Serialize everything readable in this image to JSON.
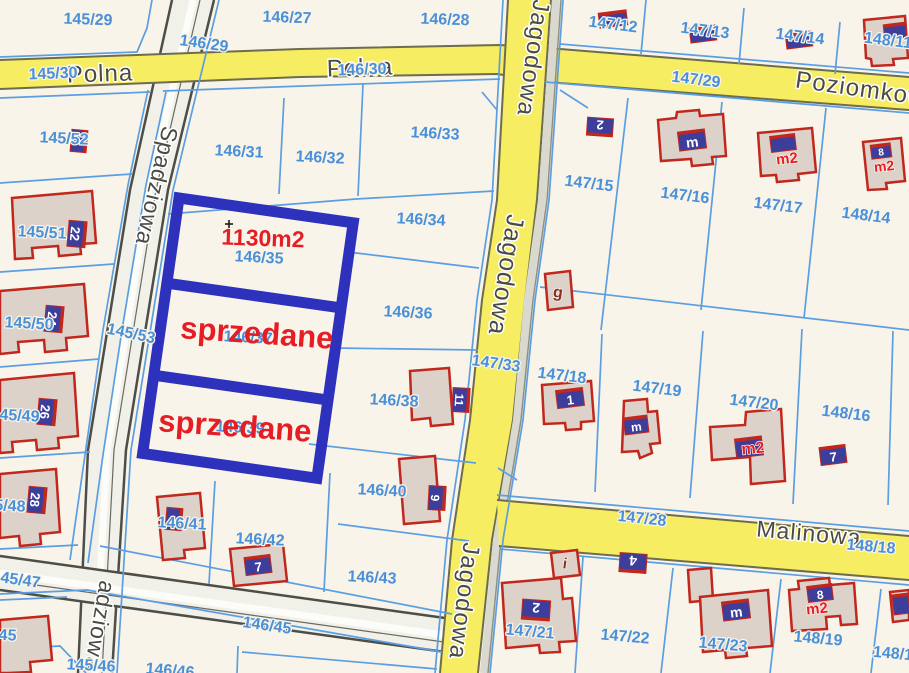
{
  "map": {
    "type": "cadastral-parcel-map",
    "colors": {
      "background": "#f8f4e9",
      "parcel_line": "#5b9ee2",
      "parcel_label": "#4a90d8",
      "street_label": "#4b4b44",
      "road_yellow": "#f6ed62",
      "road_yellow_edge": "#6d6c4e",
      "road_gray": "#f1f0e9",
      "road_gray_edge": "#4e4e48",
      "building_fill": "#ddd2ca",
      "building_outline": "#c1271c",
      "house_plate": "#3d3e9c",
      "highlight_box": "#2d31bb",
      "sold_text": "#e51d25"
    },
    "highlight": {
      "area_label": "1130m2",
      "plot_number": "146/35",
      "sold_label_1": "sprzedane",
      "sold_label_2": "sprzedane"
    },
    "streets": [
      "Polna",
      "Poziomkowa",
      "Jagodowa",
      "Spadziowa",
      "Malinowa"
    ]
  },
  "labels": [
    {
      "t": "Polna",
      "x": 100,
      "y": 74,
      "r": -2,
      "s": 24,
      "c": "s"
    },
    {
      "t": "Polna",
      "x": 360,
      "y": 68,
      "r": -2,
      "s": 24,
      "c": "s"
    },
    {
      "t": "Poziomkowa",
      "x": 868,
      "y": 90,
      "r": 8,
      "s": 24,
      "c": "s"
    },
    {
      "t": "Malinowa",
      "x": 809,
      "y": 533,
      "r": 5,
      "s": 23,
      "c": "s"
    },
    {
      "t": "Jagodowa",
      "x": 533,
      "y": 58,
      "r": 98,
      "s": 24,
      "c": "s"
    },
    {
      "t": "Jagodowa",
      "x": 506,
      "y": 275,
      "r": 99,
      "s": 25,
      "c": "s"
    },
    {
      "t": "Jagodowa",
      "x": 464,
      "y": 601,
      "r": 97,
      "s": 24,
      "c": "s"
    },
    {
      "t": "Spadziowa",
      "x": 157,
      "y": 186,
      "r": 103,
      "s": 23,
      "c": "s"
    },
    {
      "t": "adziowa",
      "x": 100,
      "y": 626,
      "r": 100,
      "s": 23,
      "c": "s"
    },
    {
      "t": "145/29",
      "x": 88,
      "y": 20,
      "r": 2,
      "s": 16,
      "c": "p"
    },
    {
      "t": "146/27",
      "x": 287,
      "y": 18,
      "r": 2,
      "s": 16,
      "c": "p"
    },
    {
      "t": "146/28",
      "x": 445,
      "y": 20,
      "r": 2,
      "s": 16,
      "c": "p"
    },
    {
      "t": "146/29",
      "x": 204,
      "y": 44,
      "r": 8,
      "s": 16,
      "c": "p"
    },
    {
      "t": "147/12",
      "x": 613,
      "y": 25,
      "r": 7,
      "s": 16,
      "c": "p"
    },
    {
      "t": "147/13",
      "x": 705,
      "y": 31,
      "r": 7,
      "s": 16,
      "c": "p"
    },
    {
      "t": "147/14",
      "x": 800,
      "y": 37,
      "r": 7,
      "s": 16,
      "c": "p"
    },
    {
      "t": "148/11",
      "x": 888,
      "y": 41,
      "r": 7,
      "s": 16,
      "c": "p"
    },
    {
      "t": "145/30",
      "x": 53,
      "y": 74,
      "r": -2,
      "s": 16,
      "c": "p"
    },
    {
      "t": "146/30",
      "x": 362,
      "y": 70,
      "r": -2,
      "s": 16,
      "c": "p"
    },
    {
      "t": "147/29",
      "x": 696,
      "y": 80,
      "r": 7,
      "s": 16,
      "c": "p"
    },
    {
      "t": "145/52",
      "x": 64,
      "y": 139,
      "r": 3,
      "s": 16,
      "c": "p"
    },
    {
      "t": "146/31",
      "x": 239,
      "y": 152,
      "r": 3,
      "s": 16,
      "c": "p"
    },
    {
      "t": "146/32",
      "x": 320,
      "y": 158,
      "r": 3,
      "s": 16,
      "c": "p"
    },
    {
      "t": "146/33",
      "x": 435,
      "y": 134,
      "r": 3,
      "s": 16,
      "c": "p"
    },
    {
      "t": "147/15",
      "x": 589,
      "y": 184,
      "r": 7,
      "s": 16,
      "c": "p"
    },
    {
      "t": "147/16",
      "x": 685,
      "y": 196,
      "r": 7,
      "s": 16,
      "c": "p"
    },
    {
      "t": "147/17",
      "x": 778,
      "y": 206,
      "r": 7,
      "s": 16,
      "c": "p"
    },
    {
      "t": "148/14",
      "x": 866,
      "y": 216,
      "r": 7,
      "s": 16,
      "c": "p"
    },
    {
      "t": "146/34",
      "x": 421,
      "y": 220,
      "r": 3,
      "s": 16,
      "c": "p"
    },
    {
      "t": "146/36",
      "x": 408,
      "y": 313,
      "r": 3,
      "s": 16,
      "c": "p"
    },
    {
      "t": "146/37",
      "x": 248,
      "y": 338,
      "r": 3,
      "s": 16,
      "c": "p"
    },
    {
      "t": "146/39",
      "x": 240,
      "y": 428,
      "r": 3,
      "s": 16,
      "c": "p"
    },
    {
      "t": "145/53",
      "x": 131,
      "y": 334,
      "r": 12,
      "s": 16,
      "c": "p"
    },
    {
      "t": "145/51",
      "x": 42,
      "y": 233,
      "r": 3,
      "s": 16,
      "c": "p"
    },
    {
      "t": "145/50",
      "x": 29,
      "y": 324,
      "r": 3,
      "s": 16,
      "c": "p"
    },
    {
      "t": "145/49",
      "x": 15,
      "y": 416,
      "r": 3,
      "s": 16,
      "c": "p"
    },
    {
      "t": "145/48",
      "x": 1,
      "y": 506,
      "r": 3,
      "s": 16,
      "c": "p"
    },
    {
      "t": "145/47",
      "x": 16,
      "y": 580,
      "r": 8,
      "s": 16,
      "c": "p"
    },
    {
      "t": "145/45",
      "x": -8,
      "y": 635,
      "r": 3,
      "s": 16,
      "c": "p"
    },
    {
      "t": "145/46",
      "x": 91,
      "y": 666,
      "r": 3,
      "s": 16,
      "c": "p"
    },
    {
      "t": "146/46",
      "x": 170,
      "y": 671,
      "r": 5,
      "s": 16,
      "c": "p"
    },
    {
      "t": "146/45",
      "x": 267,
      "y": 626,
      "r": 8,
      "s": 16,
      "c": "p"
    },
    {
      "t": "146/41",
      "x": 182,
      "y": 524,
      "r": 3,
      "s": 16,
      "c": "p"
    },
    {
      "t": "146/42",
      "x": 260,
      "y": 540,
      "r": 3,
      "s": 16,
      "c": "p"
    },
    {
      "t": "146/43",
      "x": 372,
      "y": 578,
      "r": 3,
      "s": 16,
      "c": "p"
    },
    {
      "t": "146/38",
      "x": 394,
      "y": 401,
      "r": 3,
      "s": 16,
      "c": "p"
    },
    {
      "t": "146/40",
      "x": 382,
      "y": 491,
      "r": 3,
      "s": 16,
      "c": "p"
    },
    {
      "t": "147/33",
      "x": 496,
      "y": 364,
      "r": 8,
      "s": 16,
      "c": "p"
    },
    {
      "t": "147/18",
      "x": 562,
      "y": 376,
      "r": 7,
      "s": 16,
      "c": "p"
    },
    {
      "t": "147/19",
      "x": 657,
      "y": 389,
      "r": 7,
      "s": 16,
      "c": "p"
    },
    {
      "t": "147/20",
      "x": 754,
      "y": 403,
      "r": 7,
      "s": 16,
      "c": "p"
    },
    {
      "t": "148/16",
      "x": 846,
      "y": 414,
      "r": 7,
      "s": 16,
      "c": "p"
    },
    {
      "t": "147/28",
      "x": 642,
      "y": 519,
      "r": 6,
      "s": 16,
      "c": "p"
    },
    {
      "t": "148/18",
      "x": 871,
      "y": 547,
      "r": 5,
      "s": 16,
      "c": "p"
    },
    {
      "t": "147/21",
      "x": 530,
      "y": 632,
      "r": 5,
      "s": 16,
      "c": "p"
    },
    {
      "t": "147/22",
      "x": 625,
      "y": 637,
      "r": 5,
      "s": 16,
      "c": "p"
    },
    {
      "t": "147/23",
      "x": 723,
      "y": 645,
      "r": 5,
      "s": 16,
      "c": "p"
    },
    {
      "t": "148/19",
      "x": 818,
      "y": 639,
      "r": 5,
      "s": 16,
      "c": "p"
    },
    {
      "t": "148/1",
      "x": 893,
      "y": 654,
      "r": 5,
      "s": 16,
      "c": "p"
    },
    {
      "t": "146/35",
      "x": 259,
      "y": 258,
      "r": 3,
      "s": 16,
      "c": "p"
    },
    {
      "t": "g",
      "x": 558,
      "y": 293,
      "r": 8,
      "s": 16,
      "c": "b"
    },
    {
      "t": "i",
      "x": 565,
      "y": 564,
      "r": 8,
      "s": 15,
      "c": "b"
    },
    {
      "t": "m2",
      "x": 787,
      "y": 159,
      "r": -6,
      "s": 15,
      "c": "rm"
    },
    {
      "t": "m2",
      "x": 884,
      "y": 166,
      "r": -6,
      "s": 14,
      "c": "rm"
    },
    {
      "t": "m2",
      "x": 753,
      "y": 449,
      "r": -6,
      "s": 16,
      "c": "rm"
    },
    {
      "t": "m2",
      "x": 817,
      "y": 609,
      "r": -6,
      "s": 15,
      "c": "rm"
    },
    {
      "t": "1130m2",
      "x": 263,
      "y": 238,
      "r": 2,
      "s": 23,
      "c": "r"
    },
    {
      "t": "sprzedane",
      "x": 257,
      "y": 333,
      "r": 4,
      "s": 31,
      "c": "r"
    },
    {
      "t": "sprzedane",
      "x": 235,
      "y": 426,
      "r": 4,
      "s": 31,
      "c": "r"
    }
  ],
  "plates": [
    {
      "t": "22",
      "x": 77,
      "y": 234,
      "r": 95,
      "w": 26,
      "h": 18
    },
    {
      "t": "24",
      "x": 54,
      "y": 319,
      "r": 95,
      "w": 26,
      "h": 18
    },
    {
      "t": "26",
      "x": 47,
      "y": 412,
      "r": 95,
      "w": 26,
      "h": 18
    },
    {
      "t": "28",
      "x": 37,
      "y": 500,
      "r": 95,
      "w": 26,
      "h": 18
    },
    {
      "t": "",
      "x": 79,
      "y": 141,
      "r": 95,
      "w": 22,
      "h": 16
    },
    {
      "t": "",
      "x": 174,
      "y": 519,
      "r": 95,
      "w": 22,
      "h": 16
    },
    {
      "t": "7",
      "x": 258,
      "y": 565,
      "r": -7,
      "w": 26,
      "h": 18
    },
    {
      "t": "11",
      "x": 461,
      "y": 400,
      "r": 93,
      "w": 24,
      "h": 17
    },
    {
      "t": "9",
      "x": 437,
      "y": 498,
      "r": 93,
      "w": 24,
      "h": 17
    },
    {
      "t": "1",
      "x": 570,
      "y": 398,
      "r": -7,
      "w": 27,
      "h": 18
    },
    {
      "t": "m",
      "x": 636,
      "y": 425,
      "r": -7,
      "w": 24,
      "h": 17
    },
    {
      "t": "",
      "x": 749,
      "y": 447,
      "r": -7,
      "w": 27,
      "h": 19
    },
    {
      "t": "7",
      "x": 833,
      "y": 455,
      "r": -7,
      "w": 26,
      "h": 18
    },
    {
      "t": "2",
      "x": 600,
      "y": 127,
      "r": 184,
      "w": 26,
      "h": 18
    },
    {
      "t": "2",
      "x": 536,
      "y": 610,
      "r": 184,
      "w": 28,
      "h": 20
    },
    {
      "t": "4",
      "x": 633,
      "y": 563,
      "r": 184,
      "w": 27,
      "h": 19
    },
    {
      "t": "m",
      "x": 736,
      "y": 610,
      "r": -7,
      "w": 27,
      "h": 19
    },
    {
      "t": "8",
      "x": 820,
      "y": 593,
      "r": -7,
      "w": 25,
      "h": 16
    },
    {
      "t": "m",
      "x": 692,
      "y": 140,
      "r": -7,
      "w": 27,
      "h": 19
    },
    {
      "t": "",
      "x": 783,
      "y": 143,
      "r": -7,
      "w": 25,
      "h": 16
    },
    {
      "t": "8",
      "x": 881,
      "y": 151,
      "r": -7,
      "w": 20,
      "h": 14
    },
    {
      "t": "",
      "x": 613,
      "y": 19,
      "r": -7,
      "w": 28,
      "h": 15
    },
    {
      "t": "",
      "x": 703,
      "y": 34,
      "r": -7,
      "w": 26,
      "h": 15
    },
    {
      "t": "",
      "x": 799,
      "y": 40,
      "r": -7,
      "w": 26,
      "h": 15
    },
    {
      "t": "",
      "x": 895,
      "y": 31,
      "r": -7,
      "w": 22,
      "h": 15
    },
    {
      "t": "",
      "x": 901,
      "y": 604,
      "r": -7,
      "w": 16,
      "h": 20
    }
  ]
}
